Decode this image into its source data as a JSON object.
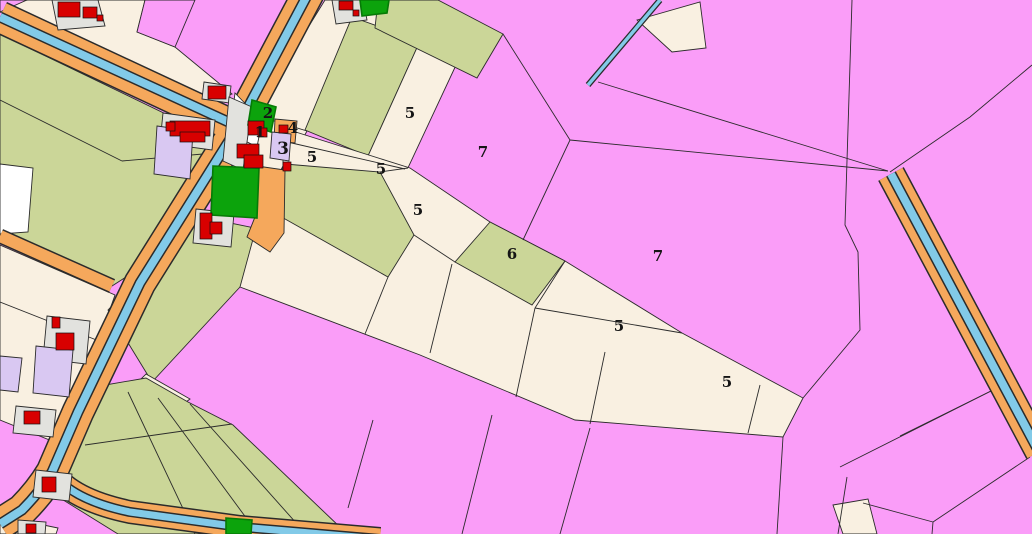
{
  "map": {
    "type": "cadastral-land-use-map",
    "parcel_labels": [
      {
        "text": "1",
        "x": 260,
        "y": 137
      },
      {
        "text": "2",
        "x": 268,
        "y": 118
      },
      {
        "text": "3",
        "x": 283,
        "y": 154
      },
      {
        "text": "4",
        "x": 293,
        "y": 133
      },
      {
        "text": "5",
        "x": 312,
        "y": 162
      },
      {
        "text": "5",
        "x": 381,
        "y": 174
      },
      {
        "text": "5",
        "x": 410,
        "y": 118
      },
      {
        "text": "5",
        "x": 418,
        "y": 215
      },
      {
        "text": "6",
        "x": 512,
        "y": 259
      },
      {
        "text": "7",
        "x": 483,
        "y": 157
      },
      {
        "text": "7",
        "x": 658,
        "y": 261
      },
      {
        "text": "5",
        "x": 619,
        "y": 331
      },
      {
        "text": "5",
        "x": 727,
        "y": 387
      }
    ],
    "features": {
      "road": "orange band",
      "canal": "blue stripe inside road band",
      "ditch": "narrow blue line",
      "building": "red block",
      "farmyard": "grey lot",
      "orchard": "dark green patch",
      "field_arable": "olive",
      "field_other": "cream",
      "greenhouse_area": "pink",
      "garden": "lavender"
    }
  },
  "colors": {
    "pink": "#FA9DF8",
    "cream": "#F9F0E1",
    "olive": "#CBD698",
    "orange": "#F5A85C",
    "water": "#82CAE8",
    "green": "#0CA30C",
    "green_border": "#067A06",
    "red": "#D80000",
    "lavender": "#D9C8F2",
    "grey": "#E2E2DE",
    "white": "#FFFFFF",
    "line": "#2B2B2B"
  }
}
